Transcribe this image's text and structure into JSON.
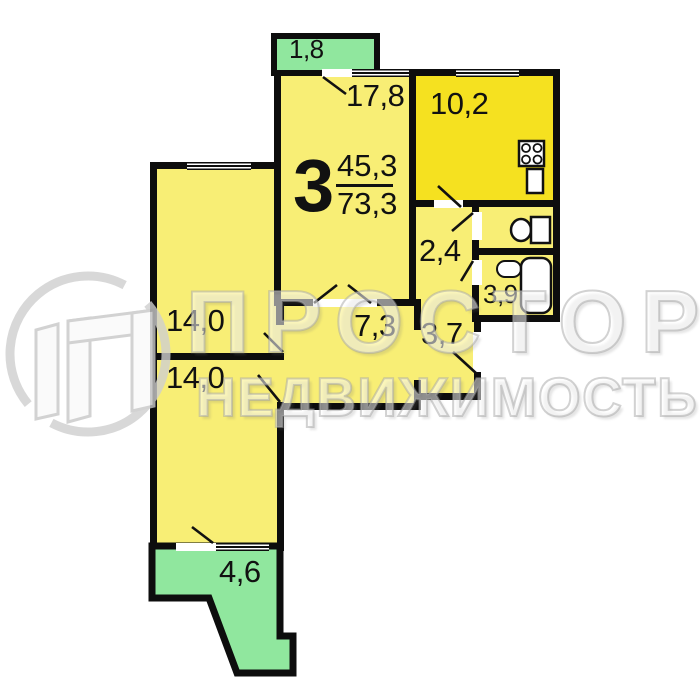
{
  "title": "3-room apartment floor plan",
  "labels": {
    "type": "3",
    "living_area": "45,3",
    "total_area": "73,3",
    "living_room": "17,8",
    "kitchen": "10,2",
    "wc_hall": "2,4",
    "bathroom": "3,9",
    "entry_hall": "3,7",
    "corridor": "7,3",
    "bedroom_upper": "14,0",
    "bedroom_lower": "14,0",
    "balcony_top": "1,8",
    "balcony_bottom": "4,6"
  },
  "watermark": {
    "brand": "ПРОСТОР",
    "subtitle": "НЕДВИЖИМОСТЬ"
  },
  "colors": {
    "room_fill": "#f8ee75",
    "kitchen_fill": "#f5e120",
    "balcony_fill": "#90e79e",
    "wall": "#0d0d0d",
    "watermark_gray": "#cfcfcf"
  }
}
